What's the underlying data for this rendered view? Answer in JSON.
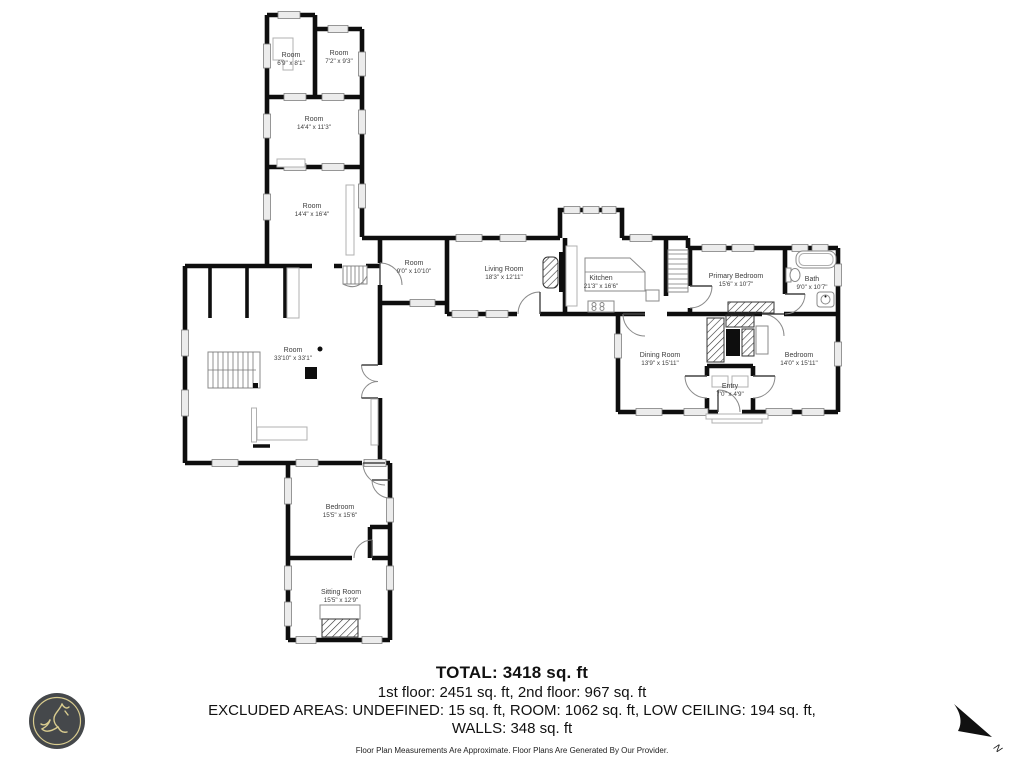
{
  "rooms": [
    {
      "name": "Room",
      "dims": "6'9\" x 8'1\""
    },
    {
      "name": "Room",
      "dims": "7'2\" x 9'3\""
    },
    {
      "name": "Room",
      "dims": "14'4\" x 11'3\""
    },
    {
      "name": "Room",
      "dims": "14'4\" x 16'4\""
    },
    {
      "name": "Room",
      "dims": "9'0\" x 10'10\""
    },
    {
      "name": "Living Room",
      "dims": "18'3\" x 12'11\""
    },
    {
      "name": "Kitchen",
      "dims": "21'3\" x 16'6\""
    },
    {
      "name": "Primary Bedroom",
      "dims": "15'6\" x 10'7\""
    },
    {
      "name": "Bath",
      "dims": "9'0\" x 10'7\""
    },
    {
      "name": "Dining Room",
      "dims": "13'9\" x 15'11\""
    },
    {
      "name": "Entry",
      "dims": "7'0\" x 4'9\""
    },
    {
      "name": "Bedroom",
      "dims": "14'0\" x 15'11\""
    },
    {
      "name": "Room",
      "dims": "33'10\" x 33'1\""
    },
    {
      "name": "Bedroom",
      "dims": "15'5\" x 15'6\""
    },
    {
      "name": "Sitting Room",
      "dims": "15'5\" x 12'9\""
    }
  ],
  "summary": {
    "total": "TOTAL: 3418 sq. ft",
    "floors": "1st floor: 2451 sq. ft, 2nd floor: 967 sq. ft",
    "excluded_line1": "EXCLUDED AREAS: UNDEFINED: 15 sq. ft, ROOM: 1062 sq. ft, LOW CEILING: 194 sq. ft,",
    "excluded_line2": "WALLS: 348 sq. ft",
    "disclaimer": "Floor Plan Measurements Are Approximate. Floor Plans Are Generated By Our Provider."
  },
  "compass": {
    "label": "N"
  },
  "colors": {
    "wall": "#0e0e0e",
    "window_fill": "#ececec",
    "logo_bg": "#45484b",
    "logo_gold": "#d9cc8f"
  }
}
